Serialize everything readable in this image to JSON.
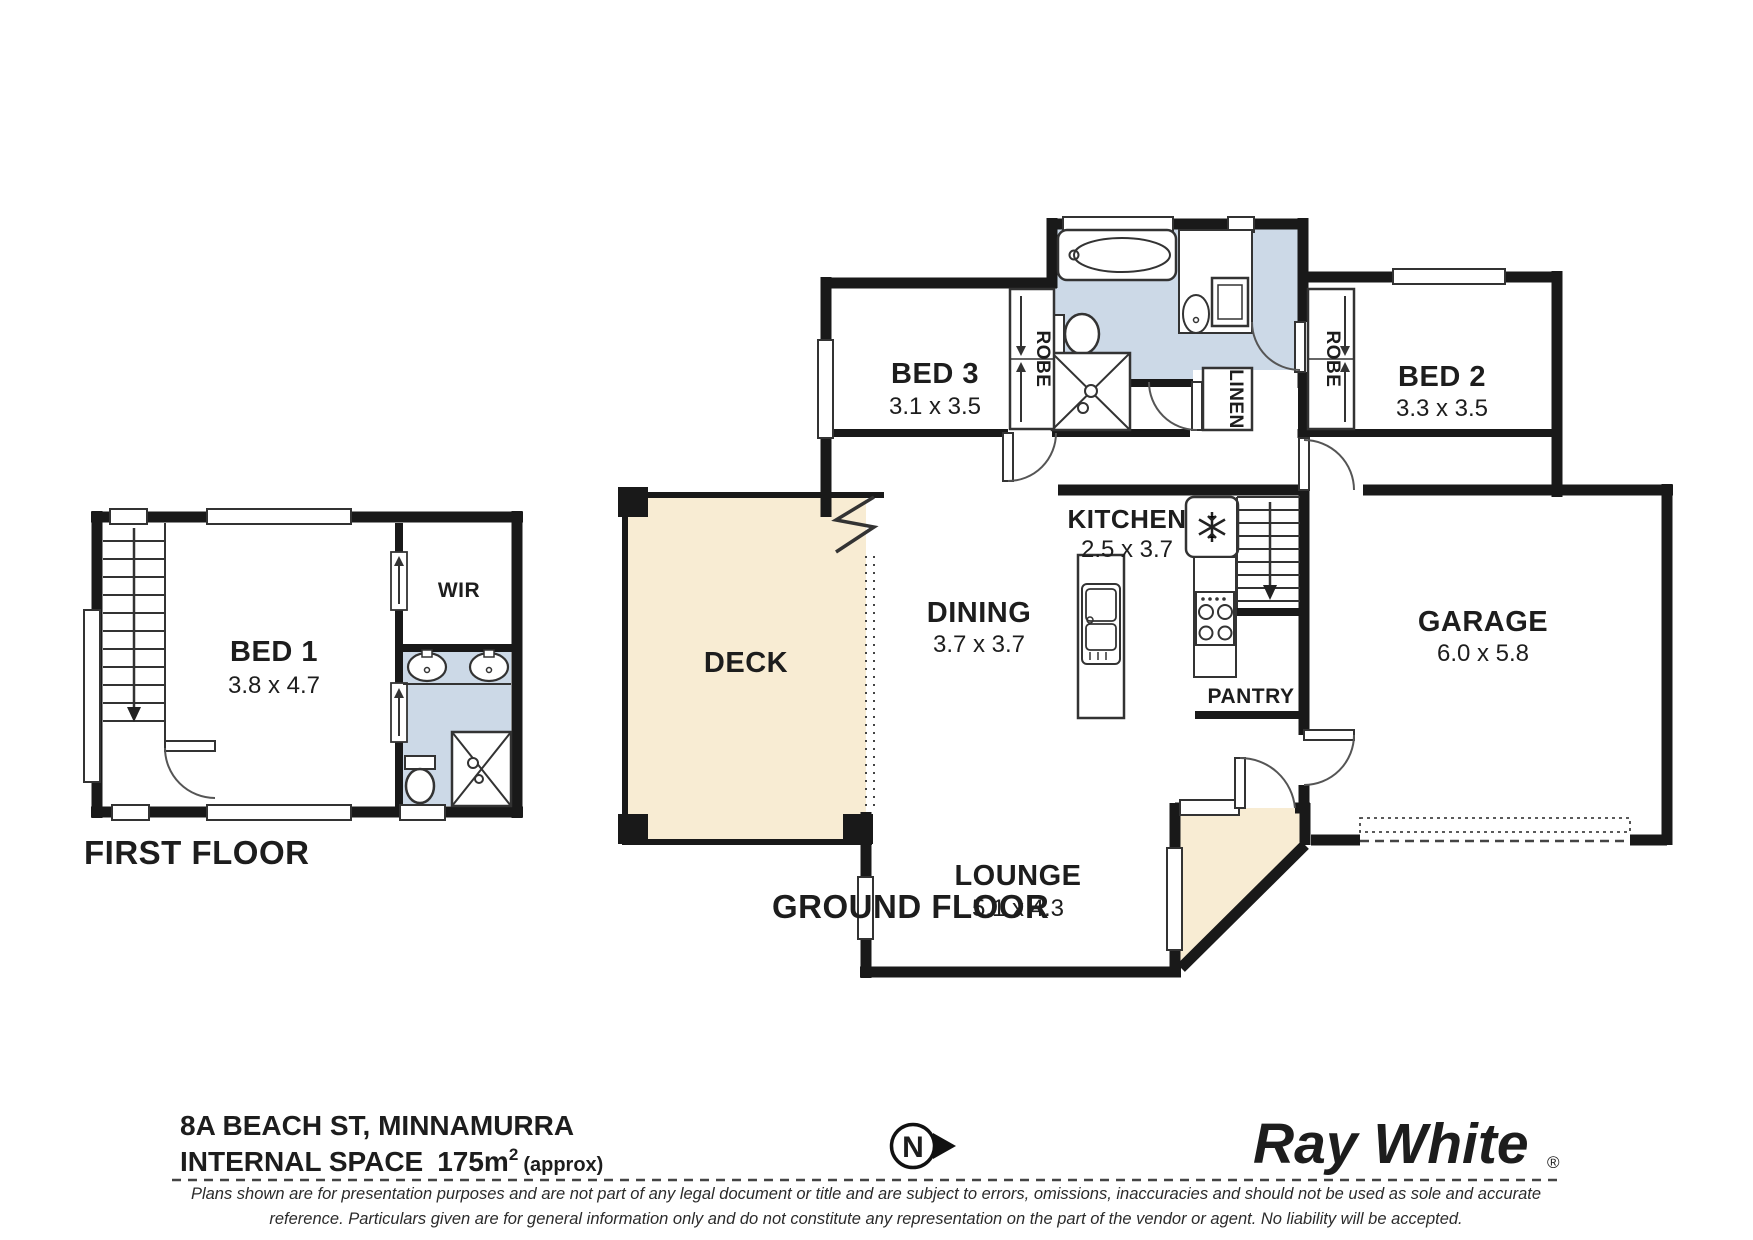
{
  "ground": {
    "label": "GROUND FLOOR",
    "bed3": {
      "label": "BED 3",
      "dims": "3.1 x 3.5"
    },
    "bed2": {
      "label": "BED 2",
      "dims": "3.3 x 3.5"
    },
    "kitchen": {
      "label": "KITCHEN",
      "dims": "2.5 x 3.7"
    },
    "dining": {
      "label": "DINING",
      "dims": "3.7 x 3.7"
    },
    "lounge": {
      "label": "LOUNGE",
      "dims": "5.1 x 4.3"
    },
    "garage": {
      "label": "GARAGE",
      "dims": "6.0 x 5.8"
    },
    "deck": {
      "label": "DECK"
    },
    "pantry": {
      "label": "PANTRY"
    },
    "robe_bed3": "ROBE",
    "robe_bed2": "ROBE",
    "linen": "LINEN"
  },
  "first": {
    "label": "FIRST FLOOR",
    "bed1": {
      "label": "BED 1",
      "dims": "3.8 x 4.7"
    },
    "wir": {
      "label": "WIR"
    }
  },
  "footer": {
    "address": "8A BEACH ST, MINNAMURRA",
    "internal_space": {
      "label": "INTERNAL SPACE",
      "value": "175m",
      "sup": "2",
      "approx": "(approx)"
    },
    "disclaimer_line1": "Plans shown are for presentation purposes and are not part of any legal document or title and are subject to errors, omissions, inaccuracies and should not be used as sole and accurate",
    "disclaimer_line2": "reference. Particulars given are for general information only and do not constitute any representation on the part of the vendor or agent. No liability will be accepted."
  },
  "compass": {
    "label": "N"
  },
  "brand": {
    "name": "Ray White",
    "reg": "®"
  },
  "colors": {
    "wall": "#191919",
    "bath_fill": "#ccd9e7",
    "deck_fill": "#f8ecd3",
    "logo": "#58585A"
  }
}
